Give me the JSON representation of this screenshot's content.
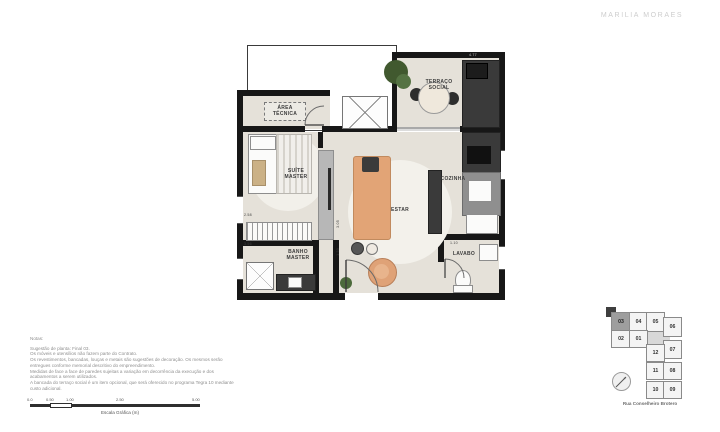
{
  "header": {
    "logo": "MARILIA MORAES"
  },
  "floorplan": {
    "rooms": [
      {
        "label": "ÁREA TÉCNICA"
      },
      {
        "label": "TERRAÇO SOCIAL"
      },
      {
        "label": "SUÍTE MASTER"
      },
      {
        "label": "ESTAR"
      },
      {
        "label": "COZINHA"
      },
      {
        "label": "BANHO MASTER"
      },
      {
        "label": "LAVABO"
      }
    ],
    "dimensions": [
      "2.58",
      "3.56",
      "3.05",
      "1.30",
      "1.10",
      "4.77"
    ]
  },
  "notes": {
    "title": "Notas:",
    "lines": [
      "Sugestão de planta: Final 03.",
      "Os móveis e utensílios não fazem parte do Contrato.",
      "Os revestimentos, bancadas, louças e metais são sugestões de decoração. Os mesmos serão",
      "entregues conforme memorial descritivo do empreendimento.",
      "Medidas de face a face de paredes sujeitas a variação em decorrência da execução e dos",
      "acabamentos a serem utilizados.",
      "A bancada do terraço social é um item opcional, que será oferecido no programa Tegra 10 mediante",
      "custo adicional."
    ]
  },
  "scalebar": {
    "ticks": [
      "0.0",
      "0.50",
      "1.00",
      "2.50",
      "5.00"
    ],
    "label": "Escala Gráfica (m)"
  },
  "keyplan": {
    "units": [
      {
        "number": "03",
        "highlighted": true
      },
      {
        "number": "04",
        "highlighted": false
      },
      {
        "number": "05",
        "highlighted": false
      },
      {
        "number": "02",
        "highlighted": false
      },
      {
        "number": "01",
        "highlighted": false
      },
      {
        "number": "06",
        "highlighted": false
      },
      {
        "number": "07",
        "highlighted": false
      },
      {
        "number": "12",
        "highlighted": false
      },
      {
        "number": "11",
        "highlighted": false
      },
      {
        "number": "08",
        "highlighted": false
      },
      {
        "number": "10",
        "highlighted": false
      },
      {
        "number": "09",
        "highlighted": false
      }
    ],
    "street": "Rua Conselheiro Brotero"
  },
  "colors": {
    "wall": "#171717",
    "floor": "#e5e1d9",
    "sofa_accent": "#e2a476",
    "unit_highlight": "#9e9e9e",
    "logo_gray": "#cdcdcd"
  }
}
